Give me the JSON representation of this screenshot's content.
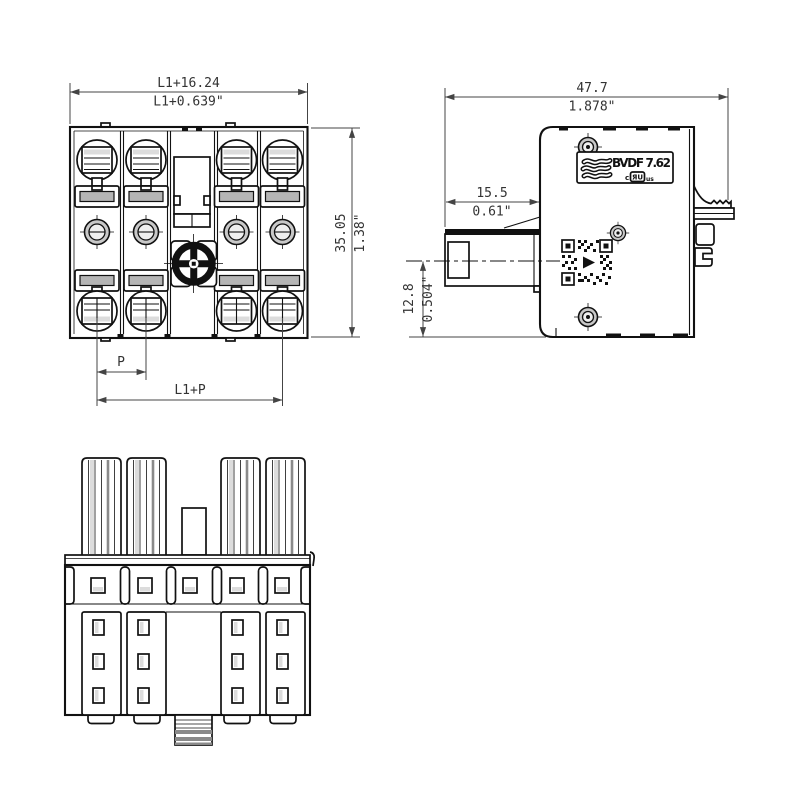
{
  "drawing": {
    "background": "#ffffff",
    "line_color": "#111111",
    "dimension_color": "#444444",
    "shade_gray": "#b5b5b5"
  },
  "dimensions": {
    "front": {
      "overall_width_mm": "L1+16.24",
      "overall_width_in": "L1+0.639\"",
      "overall_height_mm": "35.05",
      "overall_height_in": "1.38\"",
      "pitch": "P",
      "terminal_span": "L1+P"
    },
    "side": {
      "overall_width_mm": "47.7",
      "overall_width_in": "1.878\"",
      "flange_depth_mm": "15.5",
      "flange_depth_in": "0.61\"",
      "axis_height_mm": "12.8",
      "axis_height_in": "0.504\""
    }
  },
  "label": {
    "product": "BVDF 7.62",
    "cert_prefix": "c",
    "cert_symbol": "ЯU",
    "cert_suffix": "us"
  }
}
